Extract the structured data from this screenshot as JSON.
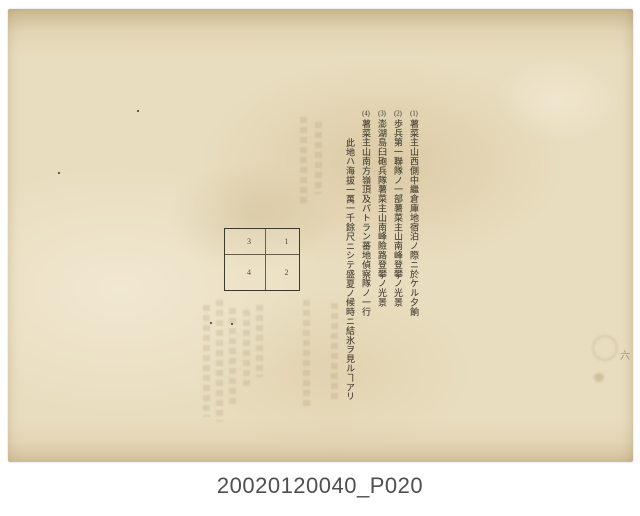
{
  "document": {
    "kind": "scanned archival page with vertical Japanese text",
    "columns": [
      {
        "number": "(1)",
        "text": "薯菜主山西側中繼倉庫地宿泊ノ際ニ於ケル夕餉"
      },
      {
        "number": "(2)",
        "text": "歩兵第一聯隊ノ一部薯菜主山南峰登攀ノ光景"
      },
      {
        "number": "(3)",
        "text": "澎湖島臼砲兵隊薯菜主山南峰險路登攀ノ光景"
      },
      {
        "number": "(4)",
        "text": "薯菜主山南方嶺頂及パトラン蕃地偵察隊ノ一行"
      },
      {
        "number": "",
        "text": "此地ハ海拔一萬一千餘尺ニシテ盛夏ノ候時ニ結氷ヲ見ルヿアリ"
      }
    ],
    "figure_table": {
      "cells": [
        [
          "3",
          "1"
        ],
        [
          "4",
          "2"
        ]
      ]
    },
    "margin_mark": "六"
  },
  "caption": "20020120040_P020",
  "colors": {
    "paper": "#e9ddbf",
    "ink": "#4a4133",
    "table_border": "#3f382c",
    "caption_text": "#4f4f4f",
    "background": "#ffffff"
  }
}
